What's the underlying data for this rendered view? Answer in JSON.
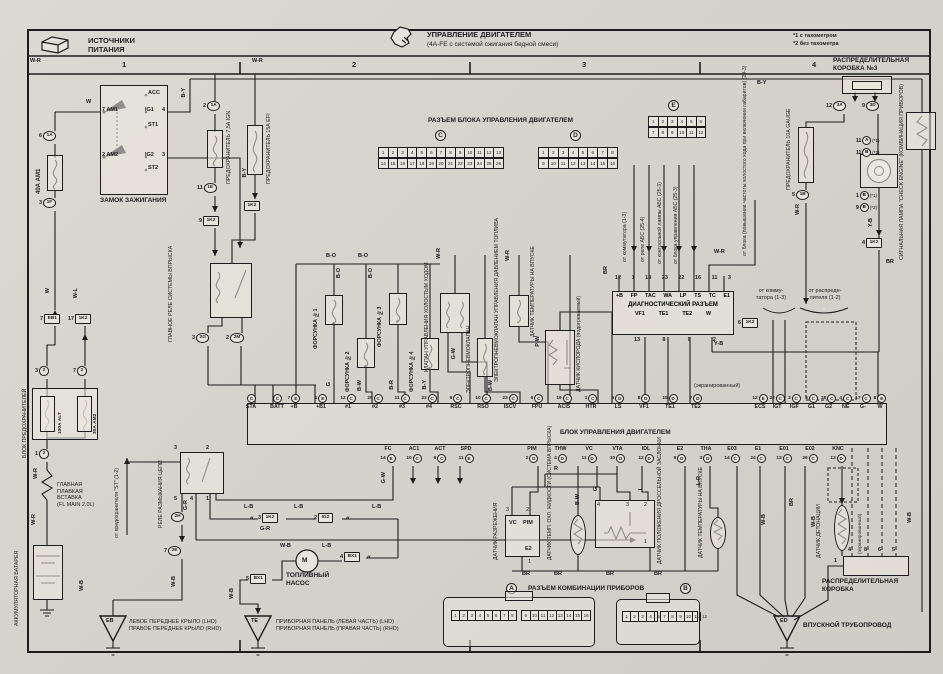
{
  "header": {
    "left1": "ИСТОЧНИКИ",
    "left2": "ПИТАНИЯ",
    "main": "УПРАВЛЕНИЕ ДВИГАТЕЛЕМ",
    "sub": "(4A-FE с системой сжигания бедной смеси)",
    "note1": "*1 с тахометром",
    "note2": "*2 без тахометра"
  },
  "cols": [
    "1",
    "2",
    "3",
    "4"
  ],
  "titles": {
    "box3": "РАСПРЕДЕЛИТЕЛЬНАЯ\nКОРОБКА №3",
    "ecu_conn": "РАЗЪЕМ БЛОКА УПРАВЛЕНИЯ ДВИГАТЕЛЕМ",
    "ecu": "БЛОК УПРАВЛЕНИЯ ДВИГАТЕЛЕМ",
    "diag": "ДИАГНОСТИЧЕСКИЙ РАЗЪЕМ",
    "cluster": "РАЗЪЕМ КОМБИНАЦИИ ПРИБОРОВ",
    "ign": "ЗАМОК ЗАЖИГАНИЯ",
    "fuseblock": "БЛОК ПРЕДОХРАНИТЕЛЕЙ",
    "link": "ГЛАВНАЯ\nПЛАВКАЯ\nВСТАВКА\n(FL MAIN 2.0L)",
    "battery": "АККУМУЛЯТОРНАЯ БАТАРЕЯ",
    "mainrelay": "ГЛАВНОЕ РЕЛЕ СИСТЕМЫ ВПРЫСКА",
    "oprelay": "РЕЛЕ РАЗМЫКАНИЯ ЦЕПИ",
    "pump": "ТОПЛИВНЫЙ\nНАСОС",
    "inj1": "ФОРСУНКА №1",
    "inj2": "ФОРСУНКА №2",
    "inj3": "ФОРСУНКА №3",
    "inj4": "ФОРСУНКА №4",
    "iscv": "КЛАПАН УПРАВЛЕНИЯ ХОЛОСТЫМ ХОДОМ",
    "vsv": "ЭЛЕКТРОПНЕВМОКЛАПАН",
    "vsvp": "ЭЛЕКТРОПНЕВМОКЛАПАН УПРАВЛЕНИЯ ДАВЛЕНИЕМ ТОПЛИВА",
    "iatmid": "ДАТЧИК ТЕМПЕРАТУРЫ НА ВПУСКЕ",
    "o2": "ДАТЧИК КИСЛОРОДА (подогреваемый)",
    "vac": "ДАТЧИК РАЗРЕЖЕНИЯ",
    "ect": "ДАТЧИК ТЕМП. ОХЛ. ЖИДКОСТИ (СИСТЕМА ВПРЫСКА)",
    "tps": "ДАТЧИК ПОЛОЖЕНИЯ ДРОССЕЛЬНОЙ ЗАСЛОНКИ",
    "iat": "ДАТЧИК ТЕМПЕРАТУРЫ НА ВПУСКЕ",
    "knock": "ДАТЧИК ДЕТОНАЦИИ",
    "distbox": "РАСПРЕДЕЛИТЕЛЬНАЯ\nКОРОБКА",
    "manifold": "ВПУСКНОЙ ТРУБОПРОВОД",
    "eb1": "ЛЕВОЕ ПЕРЕДНЕЕ КРЫЛО (LHD)",
    "eb2": "ПРАВОЕ ПЕРЕДНЕЕ КРЫЛО (RHD)",
    "te1": "ПРИБОРНАЯ ПАНЕЛЬ (ЛЕВАЯ ЧАСТЬ) (LHD)",
    "te2": "ПРИБОРНАЯ ПАНЕЛЬ (ПРАВАЯ ЧАСТЬ) (RHD)",
    "fgauge": "ПРЕДОХРАНИТЕЛЬ 10А GAUGE",
    "fefi": "ПРЕДОХРАНИТЕЛЬ 15А EFI",
    "fign": "ПРЕДОХРАНИТЕЛЬ 7,5А IGN",
    "f40": "40А AM1",
    "f100": "100А ALT",
    "f30": "30А AM2",
    "lamp": "СИГНАЛЬНАЯ ЛАМПА \"CHECK ENGINE\" (КОМБИНАЦИЯ ПРИБОРОВ)",
    "shielded": "(экранированный)",
    "fromcom": "от коммутатора (1-3)",
    "fromabsrelay": "от реле АБС (25-4)",
    "fromabslamp": "от контрольной лампы АБС (25-3)",
    "fromabsecu": "от блока управления АБС (25-3)",
    "fromblock": "от блока (повышение частоты холостого хода при включении габаритов) (29-3)",
    "fromcom2": "от комму-\nтатора (1-3)",
    "fromdist": "от распреде-\nлителя (1-2)",
    "fromst": "от предохранителя \"ST\" (1-2)"
  },
  "ign": {
    "n7": "7",
    "am1": "AM1",
    "n2": "2",
    "am2": "AM2",
    "acc": "ACC",
    "ig1": "IG1",
    "n4": "4",
    "st1": "ST1",
    "ig2": "IG2",
    "n3": "3",
    "st2": "ST2"
  },
  "diag": {
    "top_nums": [
      "12",
      "1",
      "19",
      "23",
      "22",
      "16",
      "11",
      "3"
    ],
    "top": [
      "+B",
      "FP",
      "TAC",
      "WA",
      "LP",
      "TS",
      "TC",
      "E1"
    ],
    "bottom": [
      "VF1",
      "TE1",
      "TE2",
      "W"
    ],
    "bottom_nums": [
      "13",
      "8",
      "9",
      "2"
    ]
  },
  "ecu": {
    "top_g0": [
      {
        "n": "",
        "c": "C",
        "l": "STA"
      },
      {
        "n": "",
        "c": "C",
        "l": "BATT"
      }
    ],
    "top_g1": [
      {
        "n": "7",
        "c": "E",
        "l": "+B"
      },
      {
        "n": "1",
        "c": "E",
        "l": "+B1"
      },
      {
        "n": "12",
        "c": "C",
        "l": "#1"
      },
      {
        "n": "25",
        "c": "C",
        "l": "#2"
      },
      {
        "n": "11",
        "c": "C",
        "l": "#3"
      },
      {
        "n": "23",
        "c": "C",
        "l": "#4"
      },
      {
        "n": "9",
        "c": "C",
        "l": "RSC"
      },
      {
        "n": "10",
        "c": "C",
        "l": "RSO"
      },
      {
        "n": "23",
        "c": "C",
        "l": "ISCV"
      },
      {
        "n": "6",
        "c": "C",
        "l": "FPU"
      },
      {
        "n": "19",
        "c": "C",
        "l": "ACIS"
      },
      {
        "n": "1",
        "c": "C",
        "l": "HTR"
      },
      {
        "n": "6",
        "c": "D",
        "l": "LS"
      }
    ],
    "top_g2": [
      {
        "n": "8",
        "c": "D",
        "l": "VF1"
      },
      {
        "n": "15",
        "c": "D",
        "l": "TE1"
      },
      {
        "n": "7",
        "c": "D",
        "l": "TE2"
      }
    ],
    "top_g3": [
      {
        "n": "12",
        "c": "E",
        "l": "ECS"
      },
      {
        "n": "22",
        "c": "C",
        "l": "IGT"
      },
      {
        "n": "3",
        "c": "C",
        "l": "IGF"
      },
      {
        "n": "5",
        "c": "C",
        "l": "G1"
      },
      {
        "n": "18",
        "c": "C",
        "l": "G2"
      },
      {
        "n": "4",
        "c": "C",
        "l": "NE"
      },
      {
        "n": "17",
        "c": "C",
        "l": "G-"
      },
      {
        "n": "8",
        "c": "E",
        "l": "W"
      }
    ],
    "bot_g0": [
      {
        "n": "14",
        "c": "E",
        "l": "FC"
      },
      {
        "n": "10",
        "c": "C",
        "l": "AC1"
      },
      {
        "n": "6",
        "c": "C",
        "l": "ACT"
      },
      {
        "n": "11",
        "c": "E",
        "l": "SPD"
      }
    ],
    "bot_g1": [
      {
        "n": "2",
        "c": "D",
        "l": "PIM"
      },
      {
        "n": "4",
        "c": "D",
        "l": "THW"
      },
      {
        "n": "11",
        "c": "D",
        "l": "VC"
      },
      {
        "n": "10",
        "c": "D",
        "l": "VTA"
      },
      {
        "n": "12",
        "c": "D",
        "l": "IDL"
      }
    ],
    "bot_g2": [
      {
        "n": "9",
        "c": "D",
        "l": "E2"
      },
      {
        "n": "3",
        "c": "D",
        "l": "THA"
      },
      {
        "n": "14",
        "c": "C",
        "l": "E03"
      },
      {
        "n": "24",
        "c": "C",
        "l": "E1"
      },
      {
        "n": "13",
        "c": "C",
        "l": "E01"
      },
      {
        "n": "26",
        "c": "C",
        "l": "E02"
      }
    ],
    "bot_g3": [
      {
        "n": "13",
        "c": "D",
        "l": "KNC"
      }
    ]
  },
  "grids": {
    "c_l": "C",
    "d_l": "D",
    "e_l": "E",
    "a_l": "A",
    "b_l": "B",
    "c1": [
      "1",
      "2",
      "3",
      "4",
      "5",
      "6",
      "7",
      "8",
      "9",
      "10",
      "11",
      "12",
      "13"
    ],
    "c2": [
      "14",
      "15",
      "16",
      "17",
      "18",
      "19",
      "20",
      "21",
      "22",
      "23",
      "24",
      "25",
      "26"
    ],
    "d1": [
      "1",
      "2",
      "3",
      "4",
      "5",
      "6",
      "7",
      "8"
    ],
    "d2": [
      "9",
      "10",
      "11",
      "12",
      "13",
      "14",
      "15",
      "16"
    ],
    "e1": [
      "1",
      "2",
      "3",
      "4",
      "5",
      "6"
    ],
    "e2": [
      "7",
      "8",
      "9",
      "10",
      "11",
      "12"
    ],
    "a1": [
      "1",
      "2",
      "3",
      "4",
      "5",
      "6",
      "7",
      "8"
    ],
    "a2": [
      "9",
      "10",
      "11",
      "12",
      "13",
      "14",
      "15",
      "16"
    ],
    "b1": [
      "1",
      "2",
      "3",
      "4",
      "5",
      "6"
    ],
    "b2": [
      "7",
      "8",
      "9",
      "10",
      "11",
      "12"
    ]
  },
  "conns": {
    "c01": {
      "n": "6",
      "c": "1A"
    },
    "c02": {
      "n": "3",
      "c": "1F"
    },
    "c03": {
      "n": "2",
      "c": "1A"
    },
    "c04": {
      "n": "11",
      "c": "1E"
    },
    "c05": {
      "n": "9",
      "c": "1K2"
    },
    "c06": {
      "n": "7",
      "c": "EB1"
    },
    "c07": {
      "n": "17",
      "c": "1K2"
    },
    "c08": {
      "n": "3",
      "c": "2"
    },
    "c09": {
      "n": "7",
      "c": "2"
    },
    "c10": {
      "n": "1",
      "c": "2"
    },
    "c11": {
      "n": "",
      "c": "1K2"
    },
    "c12": {
      "n": "3",
      "c": "2G"
    },
    "c13": {
      "n": "2",
      "c": "2M"
    },
    "c14": {
      "n": "",
      "c": "2H"
    },
    "c15": {
      "n": "7",
      "c": "2E"
    },
    "c16": {
      "n": "3",
      "c": "1K2"
    },
    "c17": {
      "n": "2",
      "c": "IG2"
    },
    "c18": {
      "n": "4",
      "c": "BX1"
    },
    "c19": {
      "n": "5",
      "c": "BX1"
    },
    "c20": {
      "n": "12",
      "c": "3A"
    },
    "c21": {
      "n": "9",
      "c": "3D"
    },
    "c22": {
      "n": "5",
      "c": "1B"
    },
    "c23": {
      "n": "4",
      "c": "1K2"
    },
    "c24": {
      "n": "6",
      "c": "1K2"
    }
  },
  "lamp_conns": [
    {
      "n": "11",
      "c": "A",
      "s": "(*1)"
    },
    {
      "n": "11",
      "c": "B",
      "s": "(*2)"
    },
    {
      "n": "1",
      "c": "B",
      "s": "(*1)"
    },
    {
      "n": "9",
      "c": "B",
      "s": "(*2)"
    }
  ],
  "relay_pins": {
    "r3": "3",
    "r2": "2",
    "r5": "5",
    "r4": "4",
    "r1": "1"
  },
  "tps_pins": {
    "p4": "4",
    "p3": "3",
    "p2": "2",
    "p1": "1"
  },
  "vac": {
    "vc": "VC",
    "pim": "PIM",
    "e2": "E2",
    "n3": "3",
    "n2": "2",
    "n1": "1"
  },
  "dist": {
    "p1": "1",
    "p4": "4",
    "p8": "8",
    "p6": "6",
    "p5": "5"
  },
  "gnd": {
    "eb": "EB",
    "te": "TE",
    "ed": "ED"
  },
  "misc": {
    "chev": "«",
    "pump_m": "M"
  },
  "w": [
    "W-R",
    "W-R",
    "B-Y",
    "W",
    "B-Y",
    "B-Y",
    "W-L",
    "W",
    "W-R",
    "W-R",
    "B-O",
    "B-O",
    "B-O",
    "B-O",
    "G",
    "B-W",
    "B-R",
    "B-Y",
    "G-W",
    "B-W",
    "W-R",
    "W-R",
    "P-W",
    "W-R",
    "BR",
    "Y-B",
    "BR",
    "Y-B",
    "W-R",
    "G-R",
    "L-B",
    "L-B",
    "L-B",
    "W-B",
    "L-B",
    "W-B",
    "W-B",
    "G-W",
    "G-R",
    "R",
    "G",
    "B-W",
    "L",
    "BR",
    "BR",
    "BR",
    "BR",
    "L-R",
    "BR",
    "W-B",
    "W-B",
    "W-B",
    "W-B"
  ]
}
